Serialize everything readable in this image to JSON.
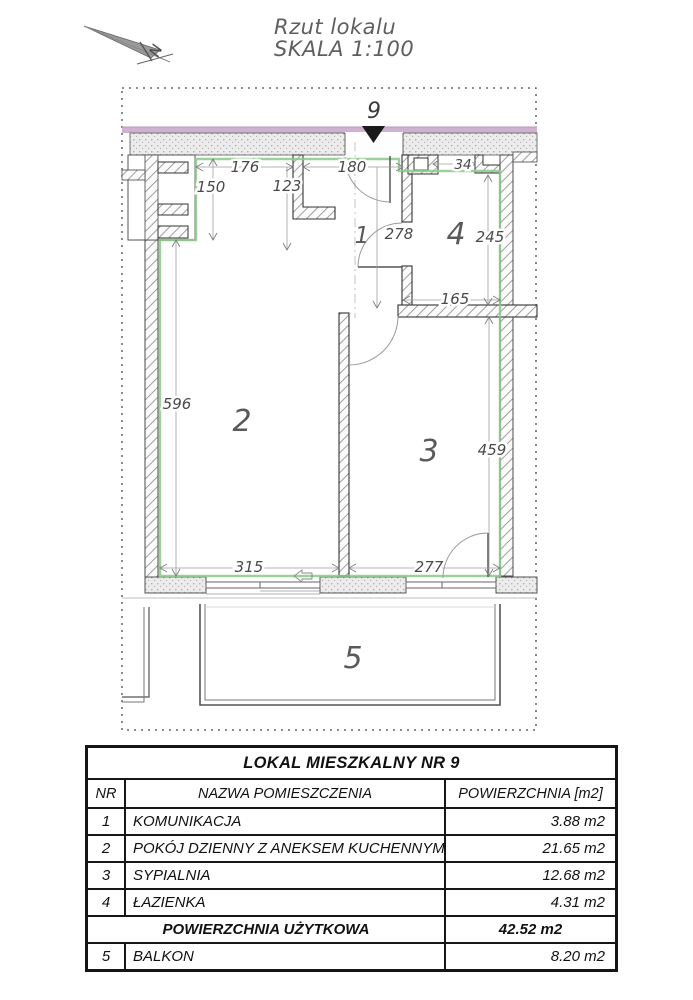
{
  "drawing": {
    "title_line1": "Rzut lokalu",
    "title_line2": "SKALA 1:100",
    "north_label": "N",
    "entrance_number": "9",
    "room_labels": [
      "1",
      "2",
      "3",
      "4",
      "5"
    ],
    "dimensions": {
      "top_left": "176",
      "top_middle": "180",
      "top_right": "34",
      "shaft": "150",
      "kitchen_wall": "123",
      "hall_height": "278",
      "bathroom_height": "245",
      "bathroom_width": "165",
      "bedroom_height": "459",
      "living_height": "596",
      "living_width": "315",
      "bedroom_width": "277"
    }
  },
  "table": {
    "title": "LOKAL MIESZKALNY NR 9",
    "columns": {
      "nr": "NR",
      "name": "NAZWA POMIESZCZENIA",
      "area": "POWIERZCHNIA [m2]"
    },
    "rows": [
      {
        "nr": "1",
        "name": "KOMUNIKACJA",
        "area": "3.88 m2"
      },
      {
        "nr": "2",
        "name": "POKÓJ DZIENNY Z ANEKSEM KUCHENNYM",
        "area": "21.65 m2"
      },
      {
        "nr": "3",
        "name": "SYPIALNIA",
        "area": "12.68 m2"
      },
      {
        "nr": "4",
        "name": "ŁAZIENKA",
        "area": "4.31 m2"
      }
    ],
    "total": {
      "label": "POWIERZCHNIA UŻYTKOWA",
      "area": "42.52 m2"
    },
    "balcony_row": {
      "nr": "5",
      "name": "BALKON",
      "area": "8.20 m2"
    }
  },
  "colors": {
    "perimeter_green": "#8bc98b",
    "facade_pink": "#cfb2cf"
  }
}
